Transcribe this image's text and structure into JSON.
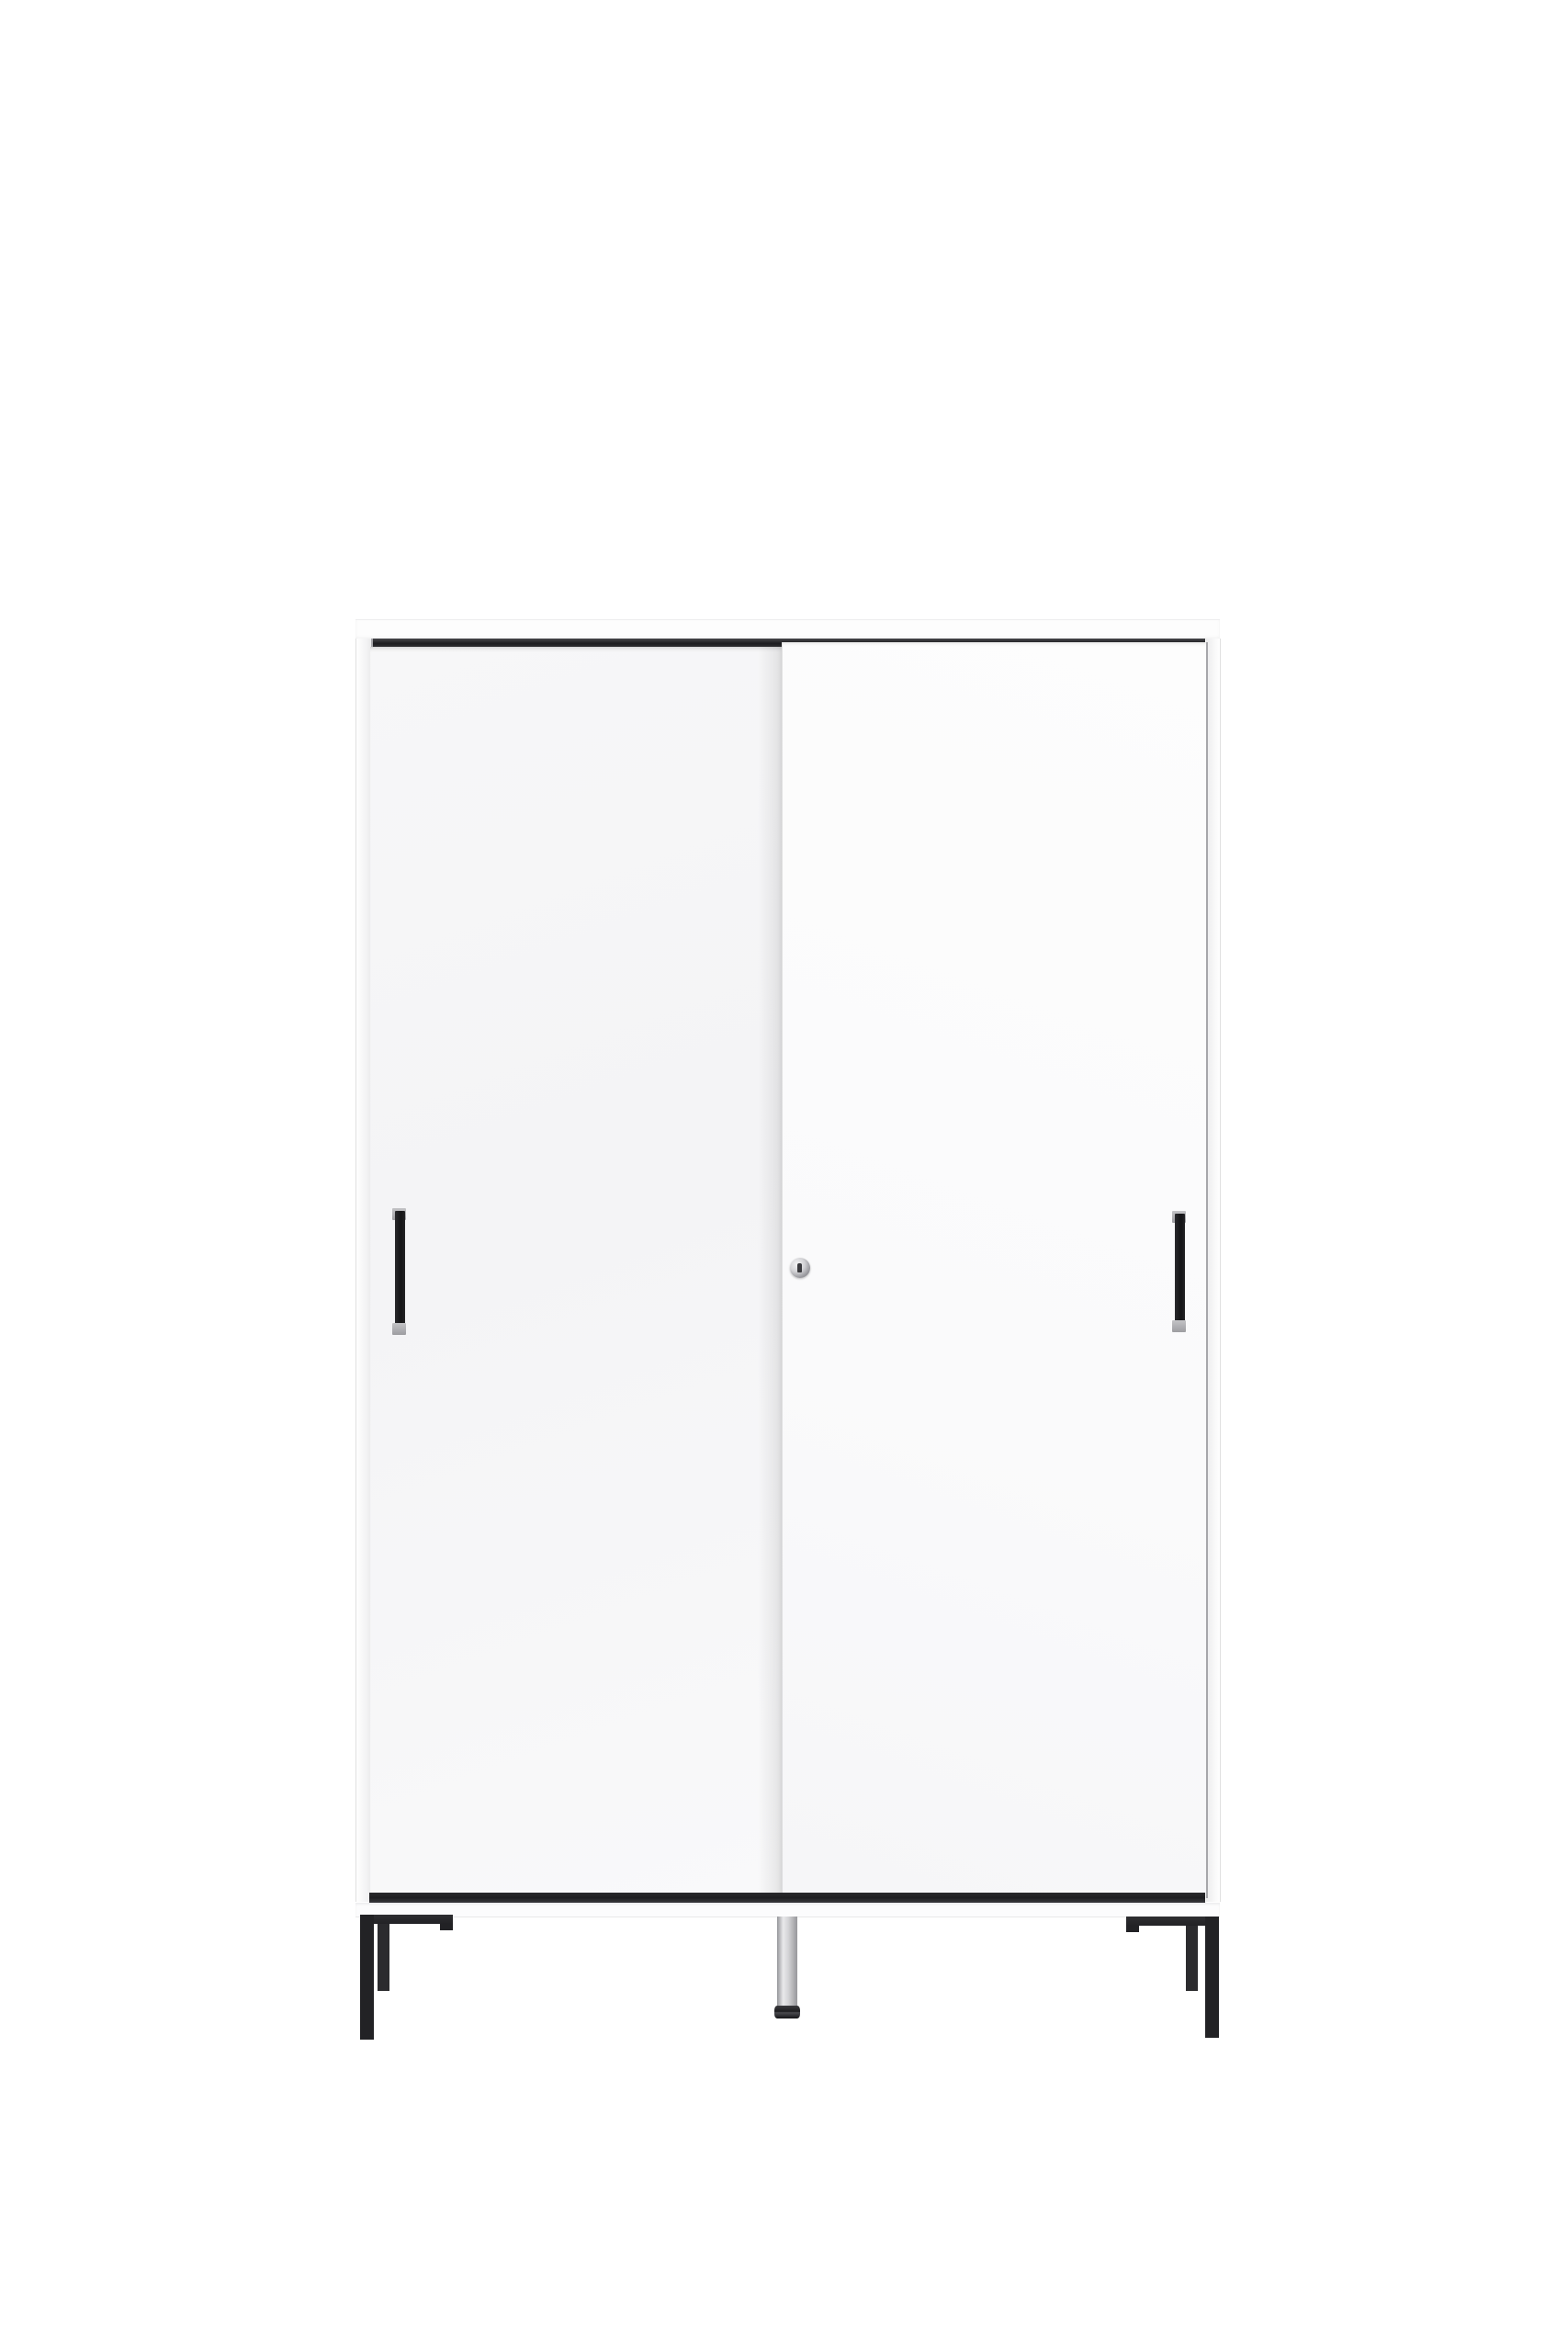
{
  "scene": {
    "subject": "white two-door sliding wardrobe product photo",
    "parts": [
      "top-panel",
      "sliding-door-top-track",
      "left-side-panel",
      "right-side-panel",
      "left-sliding-door",
      "right-sliding-door",
      "left-door-handle",
      "right-door-handle",
      "keyhole-lock",
      "sliding-door-bottom-track",
      "base-plinth",
      "left-leg-bracket",
      "right-leg-bracket",
      "center-adjustable-foot"
    ]
  },
  "colors": {
    "background": "#ffffff",
    "cabinet_face": "#fdfdfd",
    "door_left_face": "#f7f7f8",
    "door_right_face": "#fdfdfd",
    "gap_line": "#a6a6aa",
    "track_dark": "#1d1d20",
    "handle_black": "#141416",
    "handle_cap": "#c3c3c6",
    "leg_black": "#222225",
    "chrome_light": "#e9e9eb",
    "chrome_mid": "#d2d2d5",
    "foot_disc": "#3a3a3e"
  }
}
